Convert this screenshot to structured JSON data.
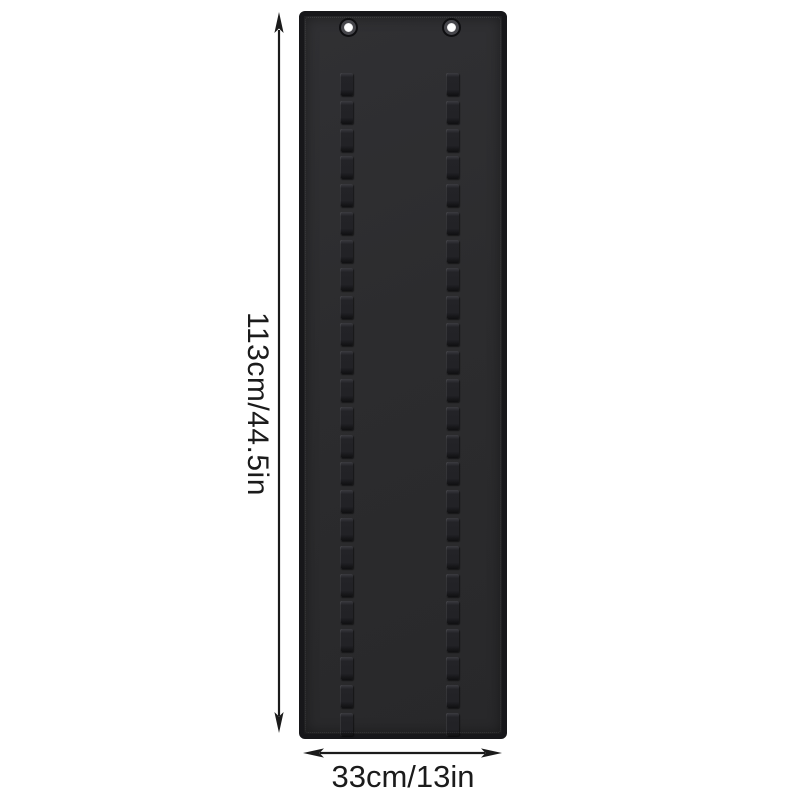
{
  "diagram": {
    "kind": "product-dimension-diagram",
    "background_color": "#ffffff",
    "line_color": "#1b1b1b"
  },
  "product": {
    "description": "black hanging organizer panel with two grommet holes and two vertical columns of elastic loops",
    "panel_face_color": "#2c2c2e",
    "panel_border_color": "#17171a",
    "loop_color": "#222226",
    "grommet_count": 2,
    "loop_columns": 2,
    "loop_segments_per_column": 24
  },
  "dimensions": {
    "height_label": "113cm/44.5in",
    "width_label": "33cm/13in"
  }
}
